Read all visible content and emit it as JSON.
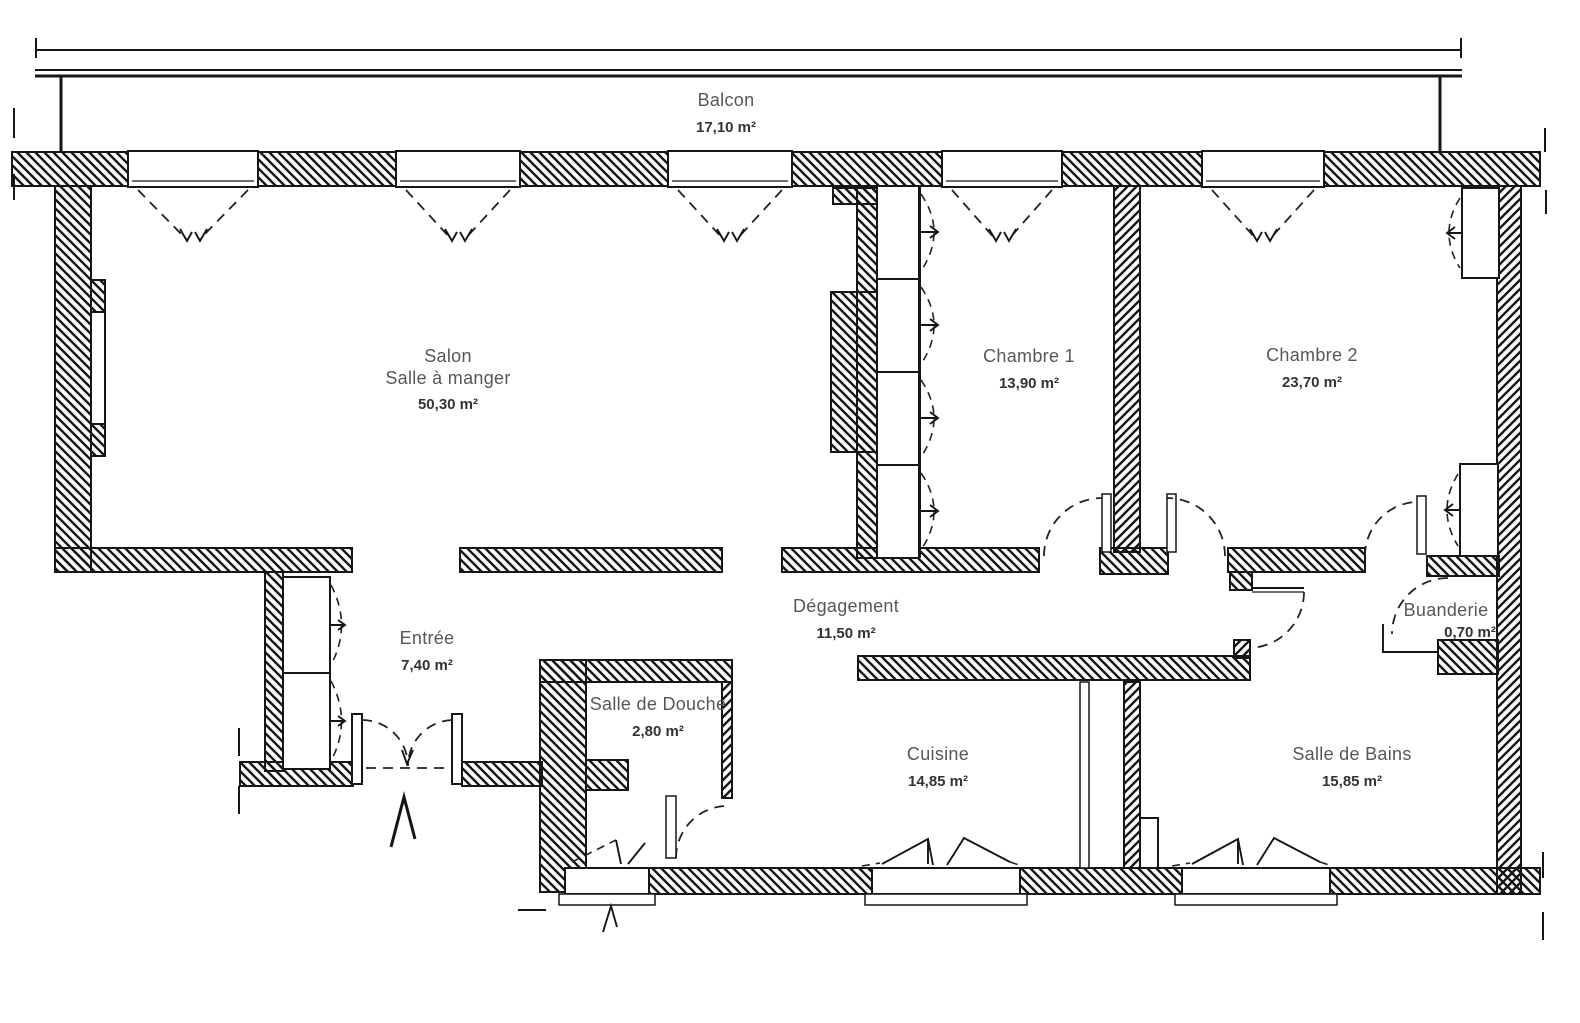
{
  "rooms": {
    "balcon": {
      "name": "Balcon",
      "area": "17,10 m²"
    },
    "salon": {
      "name": "Salon",
      "name2": "Salle à manger",
      "area": "50,30 m²"
    },
    "chambre1": {
      "name": "Chambre 1",
      "area": "13,90 m²"
    },
    "chambre2": {
      "name": "Chambre 2",
      "area": "23,70 m²"
    },
    "degagement": {
      "name": "Dégagement",
      "area": "11,50 m²"
    },
    "entree": {
      "name": "Entrée",
      "area": "7,40 m²"
    },
    "salle_de_douche": {
      "name": "Salle de Douche",
      "area": "2,80 m²"
    },
    "cuisine": {
      "name": "Cuisine",
      "area": "14,85 m²"
    },
    "salle_de_bains": {
      "name": "Salle de Bains",
      "area": "15,85 m²"
    },
    "buanderie": {
      "name": "Buanderie",
      "area": "0,70 m²"
    }
  },
  "colors": {
    "background": "#ffffff",
    "line": "#161616",
    "room_name_text": "#575757",
    "room_area_text": "#333333"
  }
}
